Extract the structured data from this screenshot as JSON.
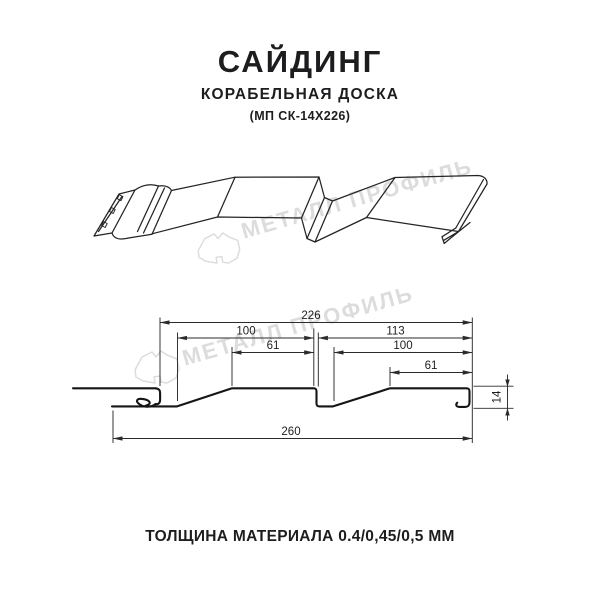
{
  "header": {
    "title": "САЙДИНГ",
    "subtitle": "КОРАБЕЛЬНАЯ ДОСКА",
    "model_code": "(МП СК-14Х226)"
  },
  "watermark": {
    "brand_text": "МЕТАЛЛ ПРОФИЛЬ",
    "color": "#dcdcdc"
  },
  "cross_section": {
    "dim_total_coverage": "226",
    "dim_left_board": "100",
    "dim_left_flat": "61",
    "dim_right_module": "113",
    "dim_right_board": "100",
    "dim_right_flat": "61",
    "dim_overall_width": "260",
    "dim_profile_height": "14"
  },
  "footer": {
    "thickness_note": "ТОЛЩИНА МАТЕРИАЛА 0.4/0,45/0,5 ММ"
  },
  "style": {
    "line_color": "#1c1c1c",
    "dim_color": "#2b2b2b"
  }
}
